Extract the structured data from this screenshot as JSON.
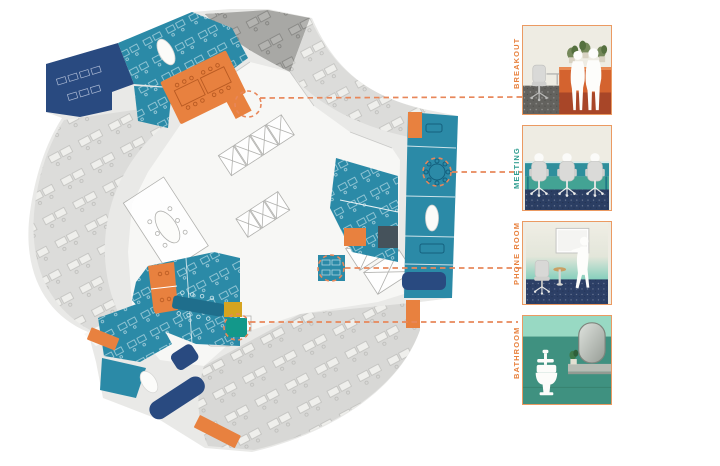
{
  "panels": [
    {
      "id": "breakout",
      "label": "BREAKOUT",
      "label_color": "#e8823f",
      "border_color": "#eb9a62",
      "scene": "breakout-room-illustration"
    },
    {
      "id": "meeting",
      "label": "MEETING",
      "label_color": "#2f9d90",
      "border_color": "#eb9a62",
      "scene": "meeting-room-illustration"
    },
    {
      "id": "phone-room",
      "label": "PHONE ROOM",
      "label_color": "#e8823f",
      "border_color": "#eb9a62",
      "scene": "phone-room-illustration"
    },
    {
      "id": "bathroom",
      "label": "BATHROOM",
      "label_color": "#e8823f",
      "border_color": "#eb9a62",
      "scene": "bathroom-illustration"
    }
  ],
  "floor_plan": {
    "type": "office-floor-plan-diagram",
    "palette": {
      "teal_rooms": "#2b8aa7",
      "navy": "#294a80",
      "orange": "#e8813f",
      "gold": "#d6a41f",
      "green_bathroom": "#13988a",
      "open_desk_gray": "#dcdcda",
      "dark_gray_zone": "#a8a8a5",
      "base_gray": "#e9e9e7",
      "core_white": "#f7f7f5",
      "connector_orange": "#e8875a",
      "dark_slate_room": "#45525b"
    },
    "callouts": [
      {
        "room": "breakout",
        "circle_x": 248,
        "circle_y": 104,
        "line_y": 98
      },
      {
        "room": "meeting",
        "circle_x": 437,
        "circle_y": 172,
        "line_y": 172
      },
      {
        "room": "phone-room",
        "circle_x": 331,
        "circle_y": 268,
        "line_y": 268
      },
      {
        "room": "bathroom",
        "circle_x": 237,
        "circle_y": 327,
        "line_y": 322
      }
    ]
  }
}
